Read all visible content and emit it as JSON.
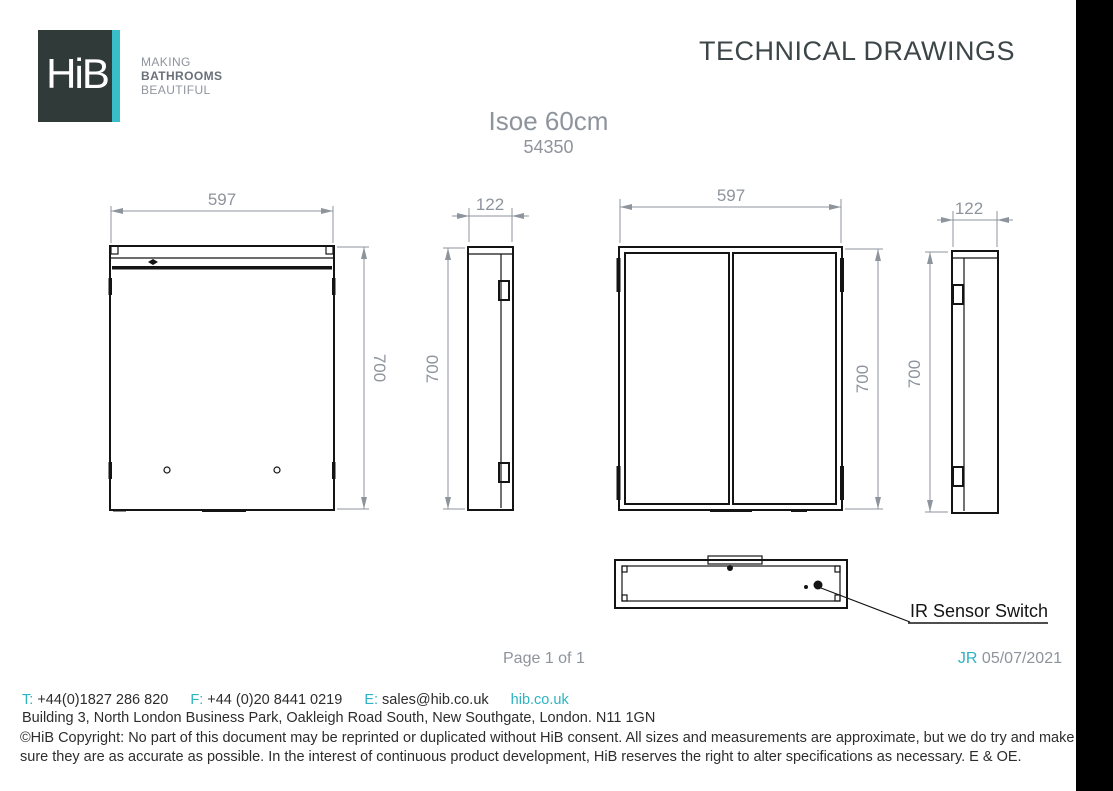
{
  "header": {
    "logo_text": "HiB",
    "tagline": [
      "MAKING",
      "BATHROOMS",
      "BEAUTIFUL"
    ],
    "title": "TECHNICAL DRAWINGS"
  },
  "product": {
    "name": "Isoe 60cm",
    "code": "54350"
  },
  "drawings": {
    "front_view_single_door": {
      "width_mm": "597",
      "height_mm": "700"
    },
    "side_view_left": {
      "depth_mm": "122",
      "height_mm": "700"
    },
    "front_view_double_door": {
      "width_mm": "597",
      "height_mm": "700"
    },
    "side_view_right": {
      "depth_mm": "122",
      "height_mm": "700"
    },
    "bottom_view": {
      "callout": "IR Sensor Switch"
    }
  },
  "footer": {
    "page_indicator": "Page 1 of 1",
    "revision_initials": "JR",
    "revision_date": "05/07/2021",
    "phone_label": "T:",
    "phone": "+44(0)1827 286 820",
    "fax_label": "F:",
    "fax": "+44 (0)20 8441 0219",
    "email_label": "E:",
    "email": "sales@hib.co.uk",
    "website": "hib.co.uk",
    "address": "Building 3, North London Business Park, Oakleigh Road South, New Southgate, London. N11 1GN",
    "copyright": "©HiB Copyright: No part of this document may be reprinted or duplicated without HiB consent. All sizes and measurements are approximate, but we do try and make sure they are as accurate as possible. In the interest of continuous product development, HiB reserves the right to alter specifications as necessary. E & OE."
  },
  "colors": {
    "accent_teal": "#2db3c3",
    "logo_background": "#303a39",
    "logo_stripe": "#39bec9",
    "muted_gray": "#8e949c",
    "drawing_line": "#141414",
    "footer_text": "#2d2d2d"
  }
}
